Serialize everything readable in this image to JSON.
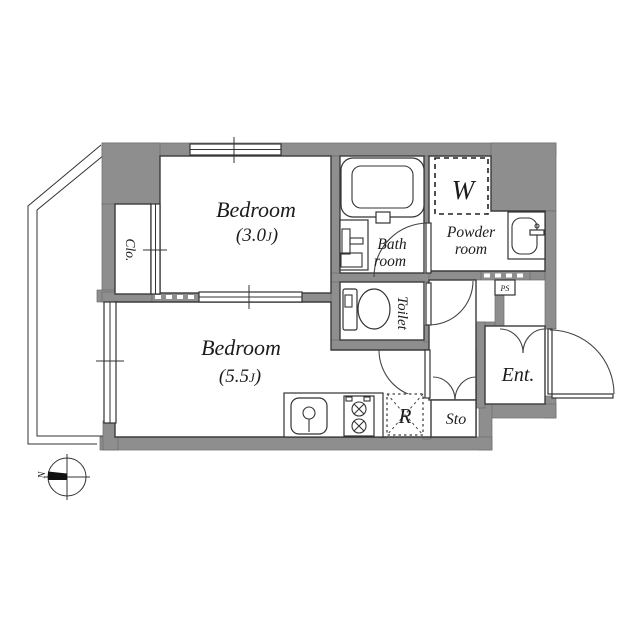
{
  "colors": {
    "background": "#ffffff",
    "wall_fill": "#8e8e8e",
    "line": "#3c3c3c",
    "text": "#1c1c1c"
  },
  "rooms": {
    "bedroom_upper": {
      "name": "Bedroom",
      "size_open": "(3.0",
      "size_unit": "J",
      "size_close": ")"
    },
    "bedroom_lower": {
      "name": "Bedroom",
      "size_open": "(5.5",
      "size_unit": "J",
      "size_close": ")"
    },
    "closet": {
      "label": "Clo."
    },
    "bath": {
      "line1": "Bath",
      "line2": "room"
    },
    "toilet": {
      "label": "Toilet"
    },
    "powder": {
      "line1": "Powder",
      "line2": "room"
    },
    "washer_space": {
      "label": "W"
    },
    "entrance": {
      "label": "Ent."
    },
    "storage": {
      "label": "Sto"
    },
    "refrigerator_space": {
      "label": "R"
    },
    "pipe_space": {
      "label": "PS"
    }
  },
  "compass": {
    "north_label": "N"
  }
}
